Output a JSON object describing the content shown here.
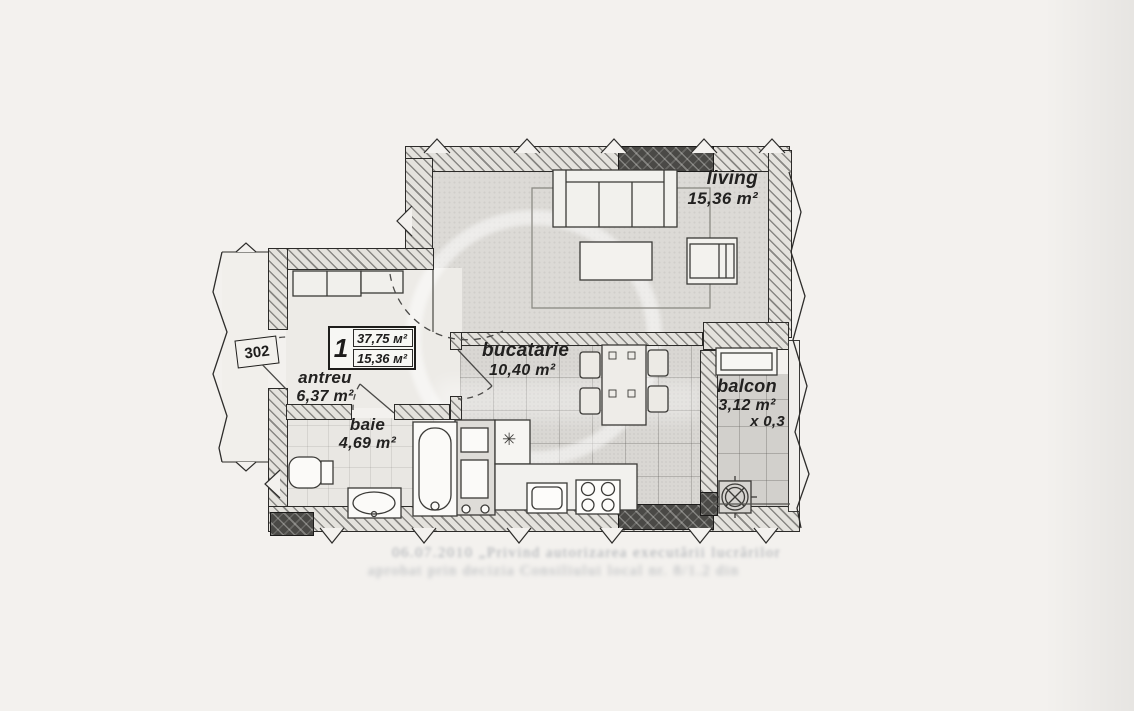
{
  "unit_badge": {
    "number": "1",
    "total_area": "37,75 м²",
    "living_area": "15,36 м²"
  },
  "door_number": "302",
  "rooms": [
    {
      "id": "living",
      "name": "living",
      "area": "15,36 m²"
    },
    {
      "id": "bucatarie",
      "name": "bucatarie",
      "area": "10,40 m²"
    },
    {
      "id": "balcon",
      "name": "balcon",
      "area": "3,12 m²",
      "coef": "x 0,3"
    },
    {
      "id": "antreu",
      "name": "antreu",
      "area": "6,37 m²"
    },
    {
      "id": "baie",
      "name": "baie",
      "area": "4,69 m²"
    }
  ],
  "icons": {
    "snowflake": "✳"
  },
  "colors": {
    "ink": "#2c2b29",
    "paper": "#f3f1ee",
    "dark_wall": "#4a4946"
  },
  "footer_bleedthrough": {
    "line1": "06.07.2010 „Privind autorizarea executării lucrărilor",
    "line2": "aprobat prin decizia Consiliului local nr. 8/1.2 din"
  }
}
